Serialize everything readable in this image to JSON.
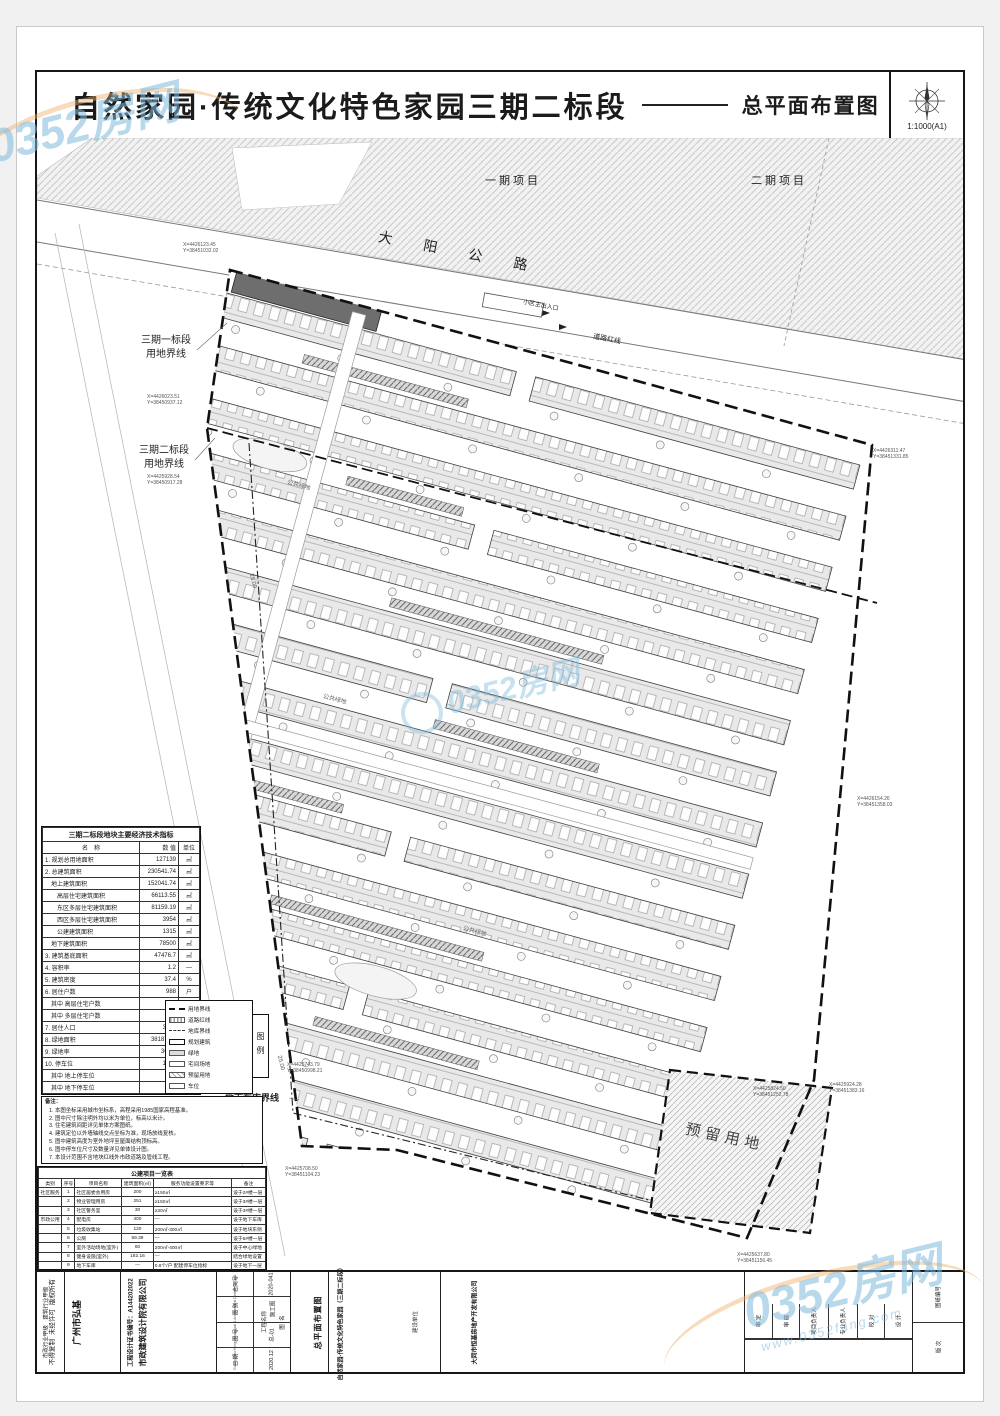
{
  "watermark": {
    "brand": "0352房网",
    "site": "www.0352fang.com"
  },
  "titlebar": {
    "title": "自然家园·传统文化特色家园三期二标段",
    "subtitle": "总平面布置图",
    "scale": "1:1000(A1)"
  },
  "map": {
    "phase1": "一期项目",
    "phase2": "二期项目",
    "road": "大 阳 公 路",
    "redline": "道路红线",
    "entrance": "小区主出入口",
    "b1a": "三期一标段",
    "b1b": "用地界线",
    "b2a": "三期二标段",
    "b2b": "用地界线",
    "garage": "地下车库界线",
    "reserved": "预留用地",
    "green1": "公共绿地",
    "green2": "公共绿地",
    "green3": "公共绿地",
    "dim1": "25.00",
    "dim2": "25.00",
    "callouts": [
      {
        "a": "X=4426123.45",
        "b": "Y=38451032.02"
      },
      {
        "a": "X=4426023.51",
        "b": "Y=38450937.12"
      },
      {
        "a": "X=4425928.54",
        "b": "Y=38450917.28"
      },
      {
        "a": "X=4426311.47",
        "b": "Y=38451331.85"
      },
      {
        "a": "X=4426154.26",
        "b": "Y=38451358.03"
      },
      {
        "a": "X=4425924.28",
        "b": "Y=38451383.16"
      },
      {
        "a": "X=4425743.79",
        "b": "Y=38450998.21"
      },
      {
        "a": "X=4425708.50",
        "b": "Y=38451104.23"
      },
      {
        "a": "X=4425824.50",
        "b": "Y=38451252.78"
      },
      {
        "a": "X=4425637.80",
        "b": "Y=38451156.45"
      }
    ]
  },
  "econ": {
    "title": "三期二标段地块主要经济技术指标",
    "h_name": "名　称",
    "h_value": "数 值",
    "h_unit": "单位",
    "rows": [
      {
        "name": "1. 规划总用地面积",
        "value": "127139",
        "unit": "㎡"
      },
      {
        "name": "2. 总建筑面积",
        "value": "230541.74",
        "unit": "㎡"
      },
      {
        "name": "　地上建筑面积",
        "value": "152041.74",
        "unit": "㎡"
      },
      {
        "name": "　　高层住宅建筑面积",
        "value": "66113.55",
        "unit": "㎡"
      },
      {
        "name": "　　东区多层住宅建筑面积",
        "value": "81159.19",
        "unit": "㎡"
      },
      {
        "name": "　　西区多层住宅建筑面积",
        "value": "3954",
        "unit": "㎡"
      },
      {
        "name": "　　公建建筑面积",
        "value": "1315",
        "unit": "㎡"
      },
      {
        "name": "　地下建筑面积",
        "value": "78500",
        "unit": "㎡"
      },
      {
        "name": "3. 建筑基底面积",
        "value": "47476.7",
        "unit": "㎡"
      },
      {
        "name": "4. 容积率",
        "value": "1.2",
        "unit": "—"
      },
      {
        "name": "5. 建筑密度",
        "value": "37.4",
        "unit": "%"
      },
      {
        "name": "6. 居住户数",
        "value": "988",
        "unit": "户"
      },
      {
        "name": "　其中 高层住宅户数",
        "value": "630",
        "unit": "户"
      },
      {
        "name": "　其中 多层住宅户数",
        "value": "358",
        "unit": "户"
      },
      {
        "name": "7. 居住人口",
        "value": "3135",
        "unit": "人"
      },
      {
        "name": "8. 绿地面积",
        "value": "38187.65",
        "unit": "㎡"
      },
      {
        "name": "9. 绿地率",
        "value": "30.04",
        "unit": "%"
      },
      {
        "name": "10. 停车位",
        "value": "1213",
        "unit": "个"
      },
      {
        "name": "　其中 地上停车位",
        "value": "528",
        "unit": "个"
      },
      {
        "name": "　其中 地下停车位",
        "value": "685",
        "unit": "个"
      }
    ]
  },
  "notes": {
    "title": "备注：",
    "items": [
      "本图坐标采用城市坐标系，高程采用1985国家高程基准。",
      "图中尺寸除注明外均以米为单位，标高以米计。",
      "住宅建筑间距详见单体方案图纸。",
      "建筑定位以外墙轴线交点坐标为准，现场放线复核。",
      "图中建筑高度为室外地坪至屋面结构顶标高。",
      "图中停车位尺寸及数量详见单体设计图。",
      "本设计范围不含地块红线外市政道路及管线工程。"
    ]
  },
  "legend": {
    "label": "图例",
    "items": [
      {
        "sw": "dash",
        "label": "用地界线"
      },
      {
        "sw": "hatchline",
        "label": "道路红线"
      },
      {
        "sw": "dashdot",
        "label": "地库界线"
      },
      {
        "sw": "outline",
        "label": "规划建筑"
      },
      {
        "sw": "gray",
        "label": "绿地"
      },
      {
        "sw": "white",
        "label": "宅间场地"
      },
      {
        "sw": "cross",
        "label": "预留用地"
      },
      {
        "sw": "white2",
        "label": "车位"
      }
    ]
  },
  "pub": {
    "title": "公建项目一览表",
    "headers": [
      "类别",
      "序号",
      "项目名称",
      "建筑面积(㎡)",
      "服务功能设置要求等",
      "备注"
    ],
    "rows": [
      {
        "cat": "社区服务",
        "no": "1",
        "name": "社区居委会用房",
        "area": "200",
        "req": "≥150㎡",
        "note": "设于2#楼一层"
      },
      {
        "cat": "",
        "no": "2",
        "name": "物业管理用房",
        "area": "251",
        "req": "≥150㎡",
        "note": "设于3#楼一层"
      },
      {
        "cat": "",
        "no": "3",
        "name": "社区警务室",
        "area": "30",
        "req": "≥30㎡",
        "note": "设于3#楼一层"
      },
      {
        "cat": "市政公用",
        "no": "4",
        "name": "配电房",
        "area": "400",
        "req": "—",
        "note": "设于地下车库"
      },
      {
        "cat": "",
        "no": "5",
        "name": "垃圾收集站",
        "area": "120",
        "req": "200㎡-300㎡",
        "note": "设于地块东侧"
      },
      {
        "cat": "",
        "no": "6",
        "name": "公厕",
        "area": "59.38",
        "req": "—",
        "note": "设于5#楼一层"
      },
      {
        "cat": "",
        "no": "7",
        "name": "室外活动场地(室外)",
        "area": "60",
        "req": "200㎡-400㎡",
        "note": "设于中心绿地"
      },
      {
        "cat": "",
        "no": "8",
        "name": "健身设施(室外)",
        "area": "182.16",
        "req": "—",
        "note": "结合绿地设置"
      },
      {
        "cat": "",
        "no": "9",
        "name": "地下车库",
        "area": "—",
        "req": "0.8个/户 配建停车位指标",
        "note": "设于地下一层"
      },
      {
        "cat": "",
        "no": "10",
        "name": "地下非机动车库",
        "area": "3750.4",
        "req": "1.5㎡/户 电动自行车停车充电设施",
        "note": "设于地下一层"
      }
    ]
  },
  "tb": {
    "copyright": [
      "版权所有",
      "未经许可",
      "不得复制"
    ],
    "cert_grade1": "市政行业甲级",
    "cert_grade2": "建筑行业甲级",
    "cert_no": "工程设计证书编号：A144202022",
    "company_cn1": "广州市弘基",
    "company_cn2": "市政建筑设计院有限公司",
    "company_en": "Guangzhou Hongji Municipal & Architectural Design Co.,Ltd.",
    "meta": [
      {
        "label": "合同号",
        "value": "2020-041"
      },
      {
        "label": "图 别",
        "value": "施工图"
      },
      {
        "label": "图 号",
        "value": "总-01"
      },
      {
        "label": "日 期",
        "value": "2020.12"
      }
    ],
    "sheet_label": "图 名",
    "sheet_name": "总平面布置图",
    "proj_label": "工程名称",
    "proj_name": "自然家园·传统文化特色家园（三期二标段）",
    "owner_label": "建设单位",
    "owner_name": "大同市恒基房地产开发有限公司",
    "signs": [
      {
        "label": "审 定",
        "name": ""
      },
      {
        "label": "审 核",
        "name": ""
      },
      {
        "label": "项目负责人",
        "name": ""
      },
      {
        "label": "专业负责人",
        "name": ""
      },
      {
        "label": "校 对",
        "name": ""
      },
      {
        "label": "设 计",
        "name": ""
      }
    ],
    "extra": [
      {
        "label": "图纸编号",
        "value": ""
      },
      {
        "label": "版 次",
        "value": ""
      }
    ]
  }
}
